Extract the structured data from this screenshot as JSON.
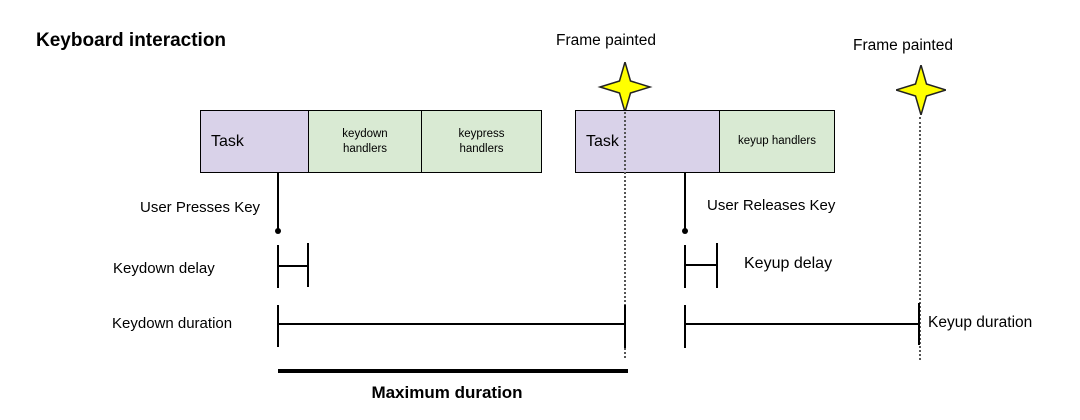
{
  "title": "Keyboard interaction",
  "colors": {
    "task_fill": "#d9d2e9",
    "handler_fill": "#d9ead3",
    "star_fill": "#ffff00",
    "line": "#000000"
  },
  "frame_markers": {
    "first_label": "Frame painted",
    "second_label": "Frame painted",
    "icon": "four-point-star"
  },
  "bars": {
    "first": {
      "cells": [
        {
          "label": "Task"
        },
        {
          "label": "keydown handlers"
        },
        {
          "label": "keypress handlers"
        }
      ]
    },
    "second": {
      "cells": [
        {
          "label": "Task"
        },
        {
          "label": "keyup handlers"
        }
      ]
    }
  },
  "annotations": {
    "user_presses_key": "User Presses Key",
    "user_releases_key": "User Releases Key",
    "keydown_delay": "Keydown delay",
    "keydown_duration": "Keydown duration",
    "keyup_delay": "Keyup delay",
    "keyup_duration": "Keyup duration",
    "maximum_duration": "Maximum duration"
  }
}
